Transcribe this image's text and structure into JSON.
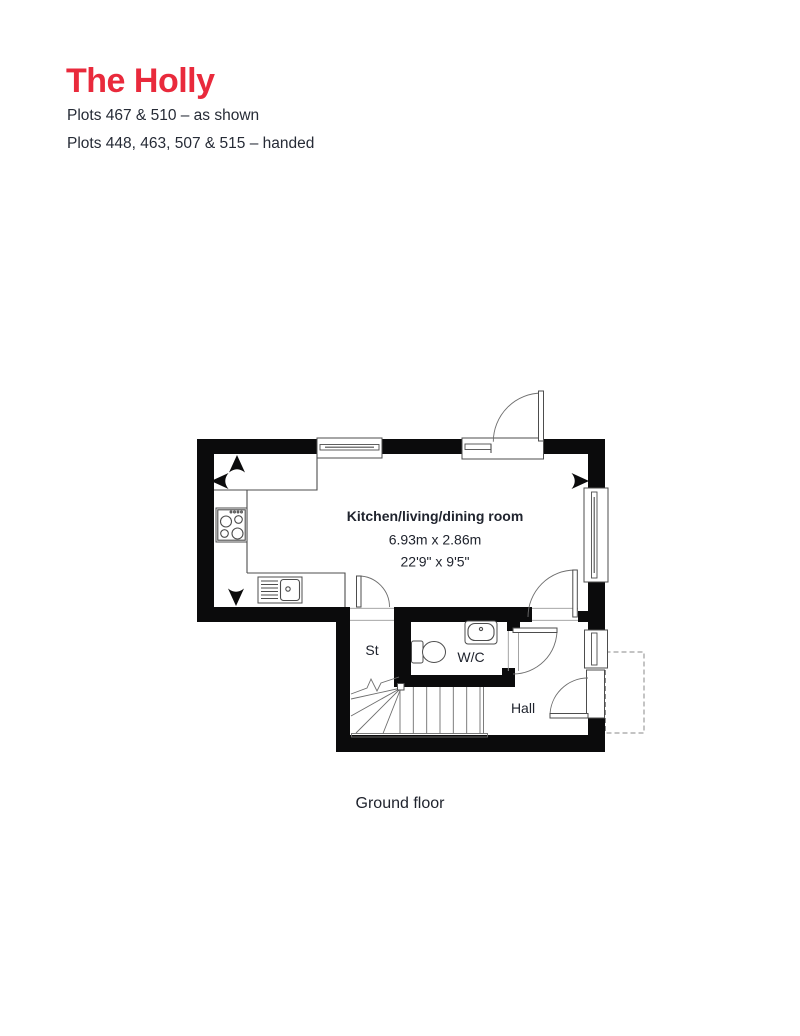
{
  "page": {
    "title": "The Holly",
    "plot_lines": {
      "as_shown": "Plots 467 & 510 – as shown",
      "handed": "Plots 448, 463, 507 & 515 – handed"
    }
  },
  "floorplan": {
    "caption": "Ground floor",
    "rooms": {
      "kitchen": {
        "name": "Kitchen/living/dining room",
        "size_metric": "6.93m x 2.86m",
        "size_imperial": "22'9\" x 9'5\""
      },
      "store": {
        "name": "St"
      },
      "wc": {
        "name": "W/C"
      },
      "hall": {
        "name": "Hall"
      }
    },
    "colors": {
      "title_red": "#e92a3c",
      "text": "#262b36",
      "wall": "#0b0b0c",
      "detail_line": "#4d4d4d"
    }
  }
}
